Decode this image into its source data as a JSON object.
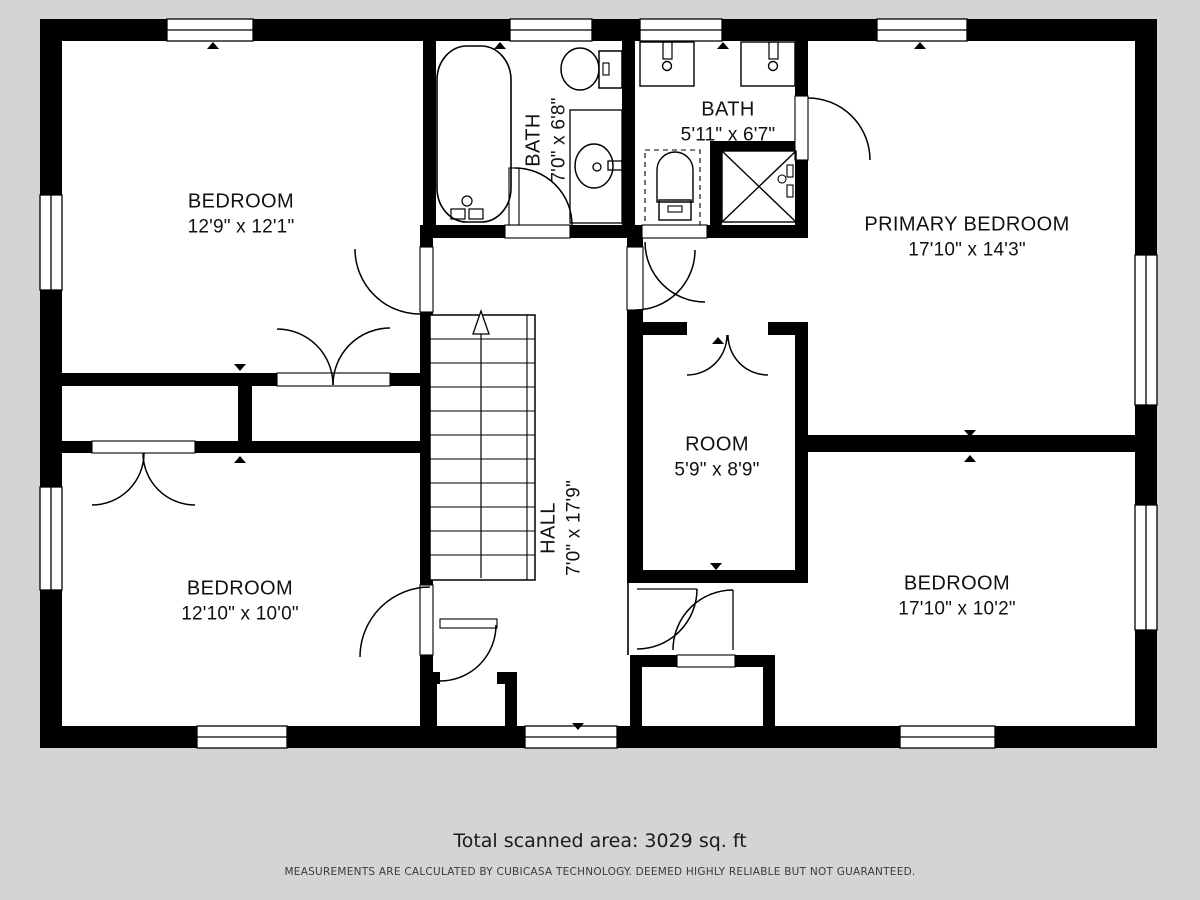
{
  "plan": {
    "rooms": [
      {
        "id": "bedroom-top-left",
        "name": "BEDROOM",
        "dims": "12'9\" x 12'1\""
      },
      {
        "id": "bath-left",
        "name": "BATH",
        "dims": "7'0\" x 6'8\""
      },
      {
        "id": "bath-right",
        "name": "BATH",
        "dims": "5'11\" x 6'7\""
      },
      {
        "id": "primary-bedroom",
        "name": "PRIMARY BEDROOM",
        "dims": "17'10\" x 14'3\""
      },
      {
        "id": "room",
        "name": "ROOM",
        "dims": "5'9\" x 8'9\""
      },
      {
        "id": "hall",
        "name": "HALL",
        "dims": "7'0\" x 17'9\""
      },
      {
        "id": "bedroom-bottom-left",
        "name": "BEDROOM",
        "dims": "12'10\" x 10'0\""
      },
      {
        "id": "bedroom-bottom-right",
        "name": "BEDROOM",
        "dims": "17'10\" x 10'2\""
      }
    ],
    "footer": {
      "total_area": "Total scanned area: 3029 sq. ft",
      "disclaimer": "MEASUREMENTS ARE CALCULATED BY CUBICASA TECHNOLOGY. DEEMED HIGHLY RELIABLE BUT NOT GUARANTEED."
    },
    "colors": {
      "background": "#d4d4d4",
      "walls": "#000000",
      "floor": "#ffffff"
    }
  }
}
